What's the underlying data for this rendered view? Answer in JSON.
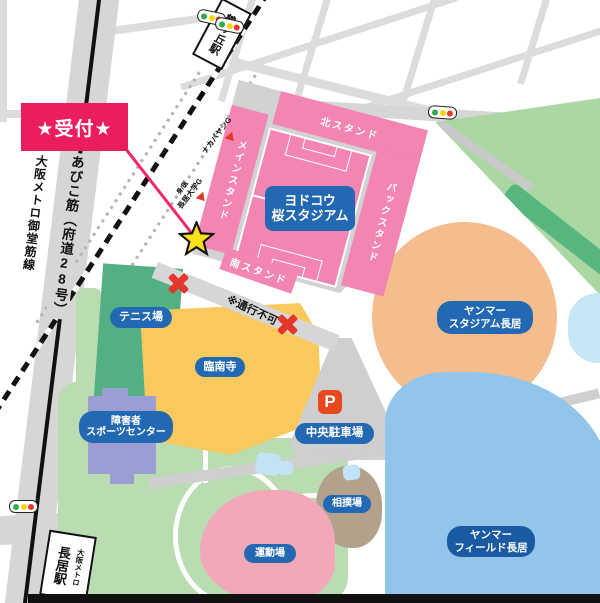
{
  "legend": {
    "reception": "★受付★",
    "no_passage": "※通行不可"
  },
  "stations": {
    "tsurugaoka": "鶴ヶ丘駅",
    "nagai_name": "長居駅",
    "nagai_operator": "大阪メトロ"
  },
  "roads": {
    "abiko": "あびこ筋（府道28号）",
    "metro_line": "大阪メトロ御堂筋線"
  },
  "yodoko_stadium": {
    "name_line1": "ヨドコウ",
    "name_line2": "桜スタジアム",
    "stand_north": "北スタンド",
    "stand_main": "メインスタンド",
    "stand_back": "バックスタンド",
    "stand_south": "南スタンド"
  },
  "gates": {
    "gate1": "ナカバヤシG",
    "gate2a": "身/医",
    "gate2b": "長居大学G"
  },
  "places": {
    "tennis": "テニス場",
    "rinnanji": "臨南寺",
    "sports1": "障害者",
    "sports2": "スポーツセンター",
    "parking_p": "P",
    "parking": "中央駐車場",
    "yanmar_stadium1": "ヤンマー",
    "yanmar_stadium2": "スタジアム長居",
    "sumo": "相撲場",
    "undojo": "運動場",
    "yanmar_field1": "ヤンマー",
    "yanmar_field2": "フィールド長居"
  },
  "colors": {
    "reception_pink": "#ea1e5e",
    "stand_pink": "#f285b2",
    "label_blue": "#2268b2",
    "temple_yellow": "#f9c95e",
    "tennis_green": "#52b083",
    "park_green": "#badcb1",
    "stadium_salmon": "#f5bc8e",
    "field_blue": "#92c5e9",
    "sumo_brown": "#b2a18b",
    "undojo_pink": "#f2a8b8",
    "parking_orange": "#e8481f",
    "star_yellow": "#ffe01a",
    "x_red": "#e5362b"
  }
}
